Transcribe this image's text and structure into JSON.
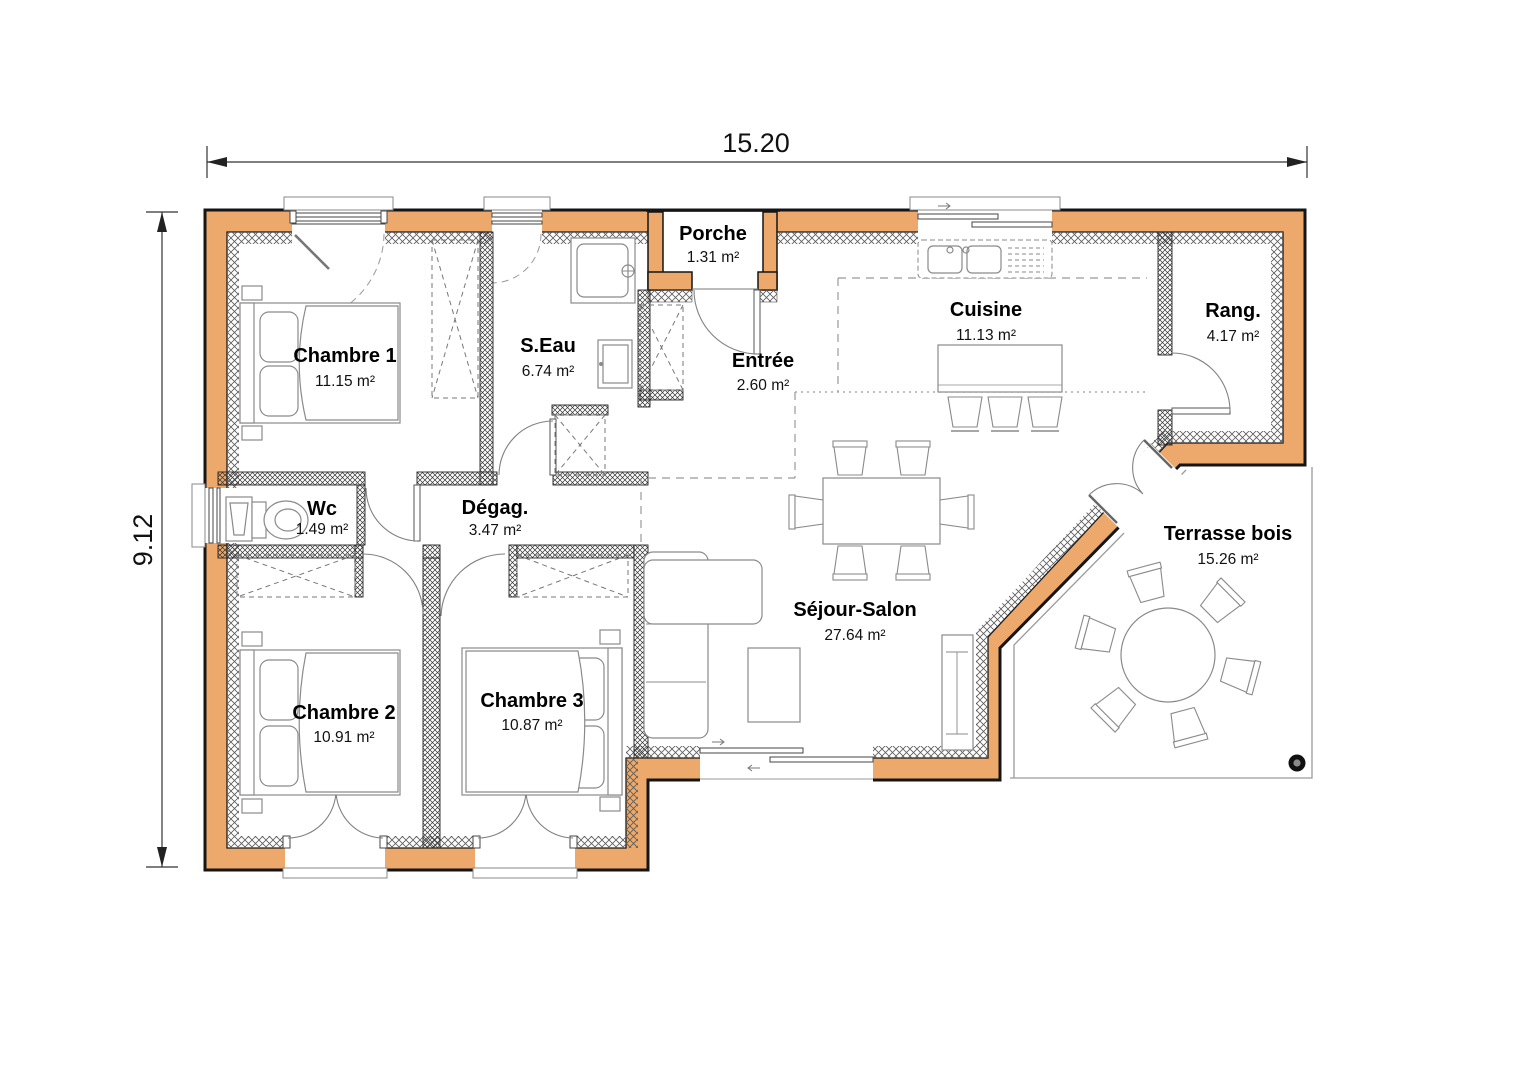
{
  "dimensions": {
    "width": "15.20",
    "height": "9.12"
  },
  "rooms": {
    "chambre1": {
      "name": "Chambre 1",
      "area": "11.15 m²"
    },
    "seau": {
      "name": "S.Eau",
      "area": "6.74 m²"
    },
    "porche": {
      "name": "Porche",
      "area": "1.31 m²"
    },
    "entree": {
      "name": "Entrée",
      "area": "2.60 m²"
    },
    "cuisine": {
      "name": "Cuisine",
      "area": "11.13 m²"
    },
    "rang": {
      "name": "Rang.",
      "area": "4.17 m²"
    },
    "wc": {
      "name": "Wc",
      "area": "1.49 m²"
    },
    "degag": {
      "name": "Dégag.",
      "area": "3.47 m²"
    },
    "chambre2": {
      "name": "Chambre 2",
      "area": "10.91 m²"
    },
    "chambre3": {
      "name": "Chambre 3",
      "area": "10.87 m²"
    },
    "sejour": {
      "name": "Séjour-Salon",
      "area": "27.64 m²"
    },
    "terrasse": {
      "name": "Terrasse bois",
      "area": "15.26 m²"
    }
  },
  "colors": {
    "wall": "#ECA96B",
    "outline": "#151515"
  }
}
